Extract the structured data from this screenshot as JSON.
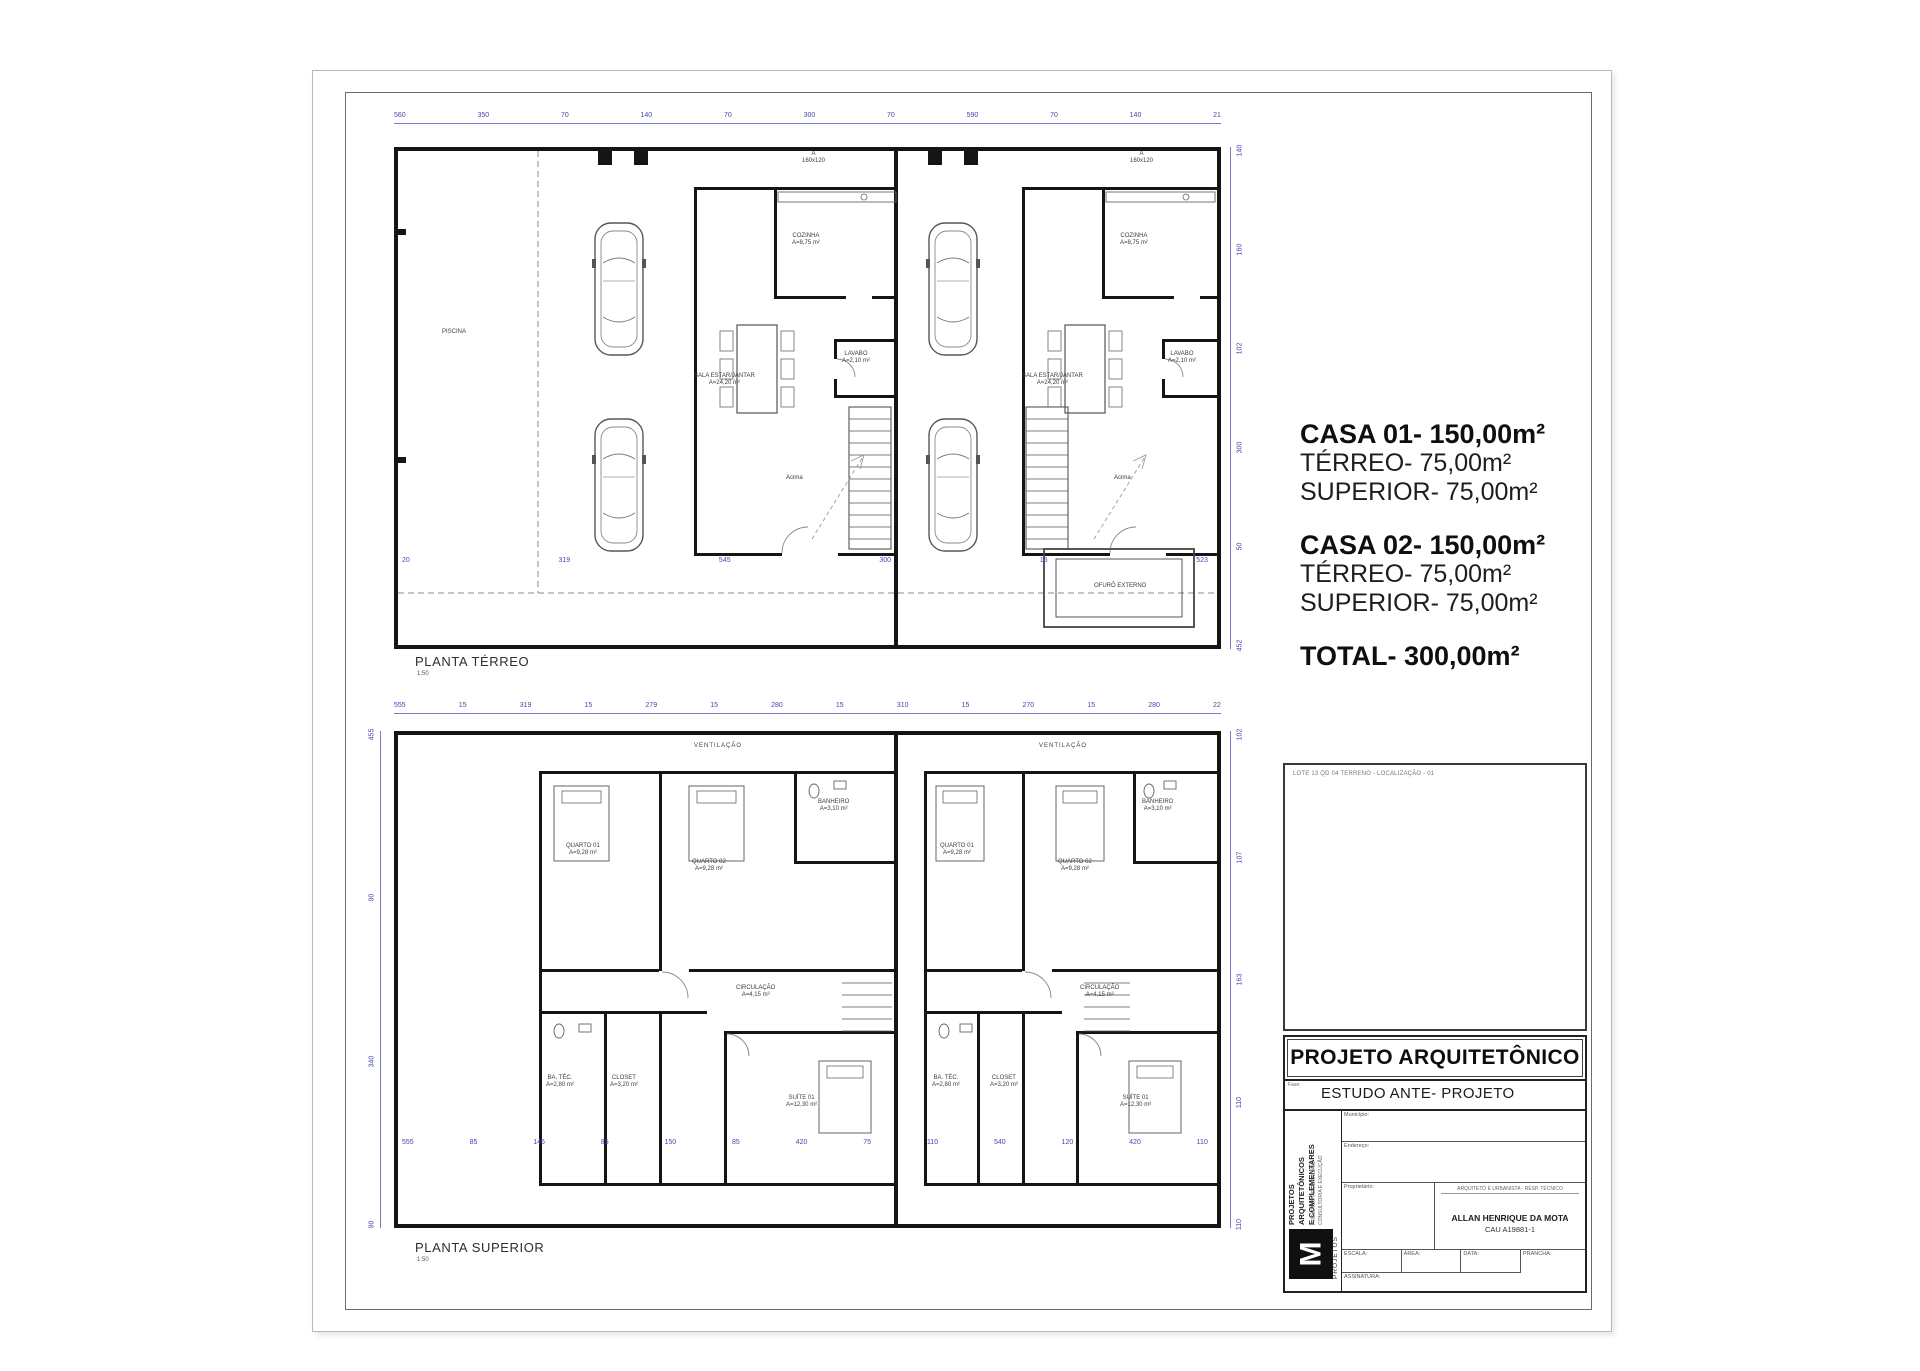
{
  "colors": {
    "dim_blue": "#4646b4",
    "wall_black": "#151515",
    "logo_bg": "#101010"
  },
  "plan_terreo": {
    "title": "PLANTA TÉRREO",
    "scale": "1:50",
    "dims_top": [
      "560",
      "350",
      "70",
      "140",
      "70",
      "300",
      "70",
      "590",
      "70",
      "140",
      "21"
    ],
    "dims_bottom": [
      "20",
      "319",
      "545",
      "300",
      "15",
      "523"
    ],
    "dims_right": [
      "140",
      "160",
      "102",
      "300",
      "50",
      "452"
    ],
    "room_labels": [
      {
        "t": "PISCINA",
        "x": 48,
        "y": 182
      },
      {
        "t": "A\n160x120",
        "x": 408,
        "y": 4
      },
      {
        "t": "A\n160x120",
        "x": 736,
        "y": 4
      },
      {
        "t": "COZINHA\nA=8,75 m²",
        "x": 398,
        "y": 86
      },
      {
        "t": "SALA ESTAR/JANTAR\nA=24,20 m²",
        "x": 300,
        "y": 226
      },
      {
        "t": "LAVABO\nA=2,10 m²",
        "x": 448,
        "y": 204
      },
      {
        "t": "Acima",
        "x": 392,
        "y": 328
      },
      {
        "t": "COZINHA\nA=8,75 m²",
        "x": 726,
        "y": 86
      },
      {
        "t": "SALA ESTAR/JANTAR\nA=24,20 m²",
        "x": 628,
        "y": 226
      },
      {
        "t": "LAVABO\nA=2,10 m²",
        "x": 774,
        "y": 204
      },
      {
        "t": "Acima",
        "x": 720,
        "y": 328
      },
      {
        "t": "OFURÔ EXTERNO",
        "x": 700,
        "y": 436
      }
    ]
  },
  "plan_superior": {
    "title": "PLANTA SUPERIOR",
    "scale": "1:50",
    "ventilacao": "VENTILAÇÃO",
    "dims_top": [
      "555",
      "15",
      "319",
      "15",
      "279",
      "15",
      "280",
      "15",
      "310",
      "15",
      "270",
      "15",
      "280",
      "22"
    ],
    "dims_bottom": [
      "555",
      "85",
      "145",
      "85",
      "150",
      "85",
      "420",
      "75",
      "110",
      "540",
      "120",
      "420",
      "110"
    ],
    "dims_left": [
      "455",
      "90",
      "340",
      "90"
    ],
    "dims_right": [
      "102",
      "107",
      "163",
      "110",
      "110"
    ],
    "room_labels": [
      {
        "t": "QUARTO 01\nA=9,28 m²",
        "x": 172,
        "y": 112
      },
      {
        "t": "QUARTO 02\nA=9,28 m²",
        "x": 298,
        "y": 128
      },
      {
        "t": "BANHEIRO\nA=3,10 m²",
        "x": 424,
        "y": 68
      },
      {
        "t": "CIRCULAÇÃO\nA=4,15 m²",
        "x": 342,
        "y": 254
      },
      {
        "t": "BA. TÉC.\nA=2,80 m²",
        "x": 152,
        "y": 344
      },
      {
        "t": "CLOSET\nA=3,20 m²",
        "x": 216,
        "y": 344
      },
      {
        "t": "SUÍTE 01\nA=12,30 m²",
        "x": 392,
        "y": 364
      },
      {
        "t": "QUARTO 01\nA=9,28 m²",
        "x": 546,
        "y": 112
      },
      {
        "t": "QUARTO 02\nA=9,28 m²",
        "x": 664,
        "y": 128
      },
      {
        "t": "BANHEIRO\nA=3,10 m²",
        "x": 748,
        "y": 68
      },
      {
        "t": "CIRCULAÇÃO\nA=4,15 m²",
        "x": 686,
        "y": 254
      },
      {
        "t": "BA. TÉC.\nA=2,80 m²",
        "x": 538,
        "y": 344
      },
      {
        "t": "CLOSET\nA=3,20 m²",
        "x": 596,
        "y": 344
      },
      {
        "t": "SUÍTE 01\nA=12,30 m²",
        "x": 726,
        "y": 364
      }
    ]
  },
  "area_summary": {
    "casa1_title": "CASA 01- 150,00m²",
    "casa1_line1": "TÉRREO- 75,00m²",
    "casa1_line2": "SUPERIOR- 75,00m²",
    "casa2_title": "CASA 02- 150,00m²",
    "casa2_line1": "TÉRREO- 75,00m²",
    "casa2_line2": "SUPERIOR- 75,00m²",
    "total": "TOTAL- 300,00m²"
  },
  "title_block": {
    "map_note": "LOTE 13 QD 04 TERRENO - LOCALIZAÇÃO - 01",
    "title": "PROJETO ARQUITETÔNICO",
    "phase_label": "Fase:",
    "phase_value": "ESTUDO ANTE- PROJETO",
    "firm_line": "PROJETOS ARQUITETÔNICOS\nE COMPLEMENTARES",
    "contact_line": "PROJETOS RESIDENCIAIS\nCONSULTORIA E EXECUÇÃO",
    "logo_letter": "M",
    "logo_caption": "PROJETOS",
    "field_municipio": "Município:",
    "field_endereco": "Endereço:",
    "field_proprietario": "Proprietário:",
    "arch_header": "ARQUITETO E URBANISTA - RESP. TÉCNICO",
    "architect_name": "ALLAN HENRIQUE DA MOTA",
    "architect_cau": "CAU A19881-1",
    "field_escala": "ESCALA:",
    "field_area": "ÁREA:",
    "field_data": "DATA:",
    "field_prancha": "PRANCHA:",
    "field_assinatura": "ASSINATURA:"
  }
}
